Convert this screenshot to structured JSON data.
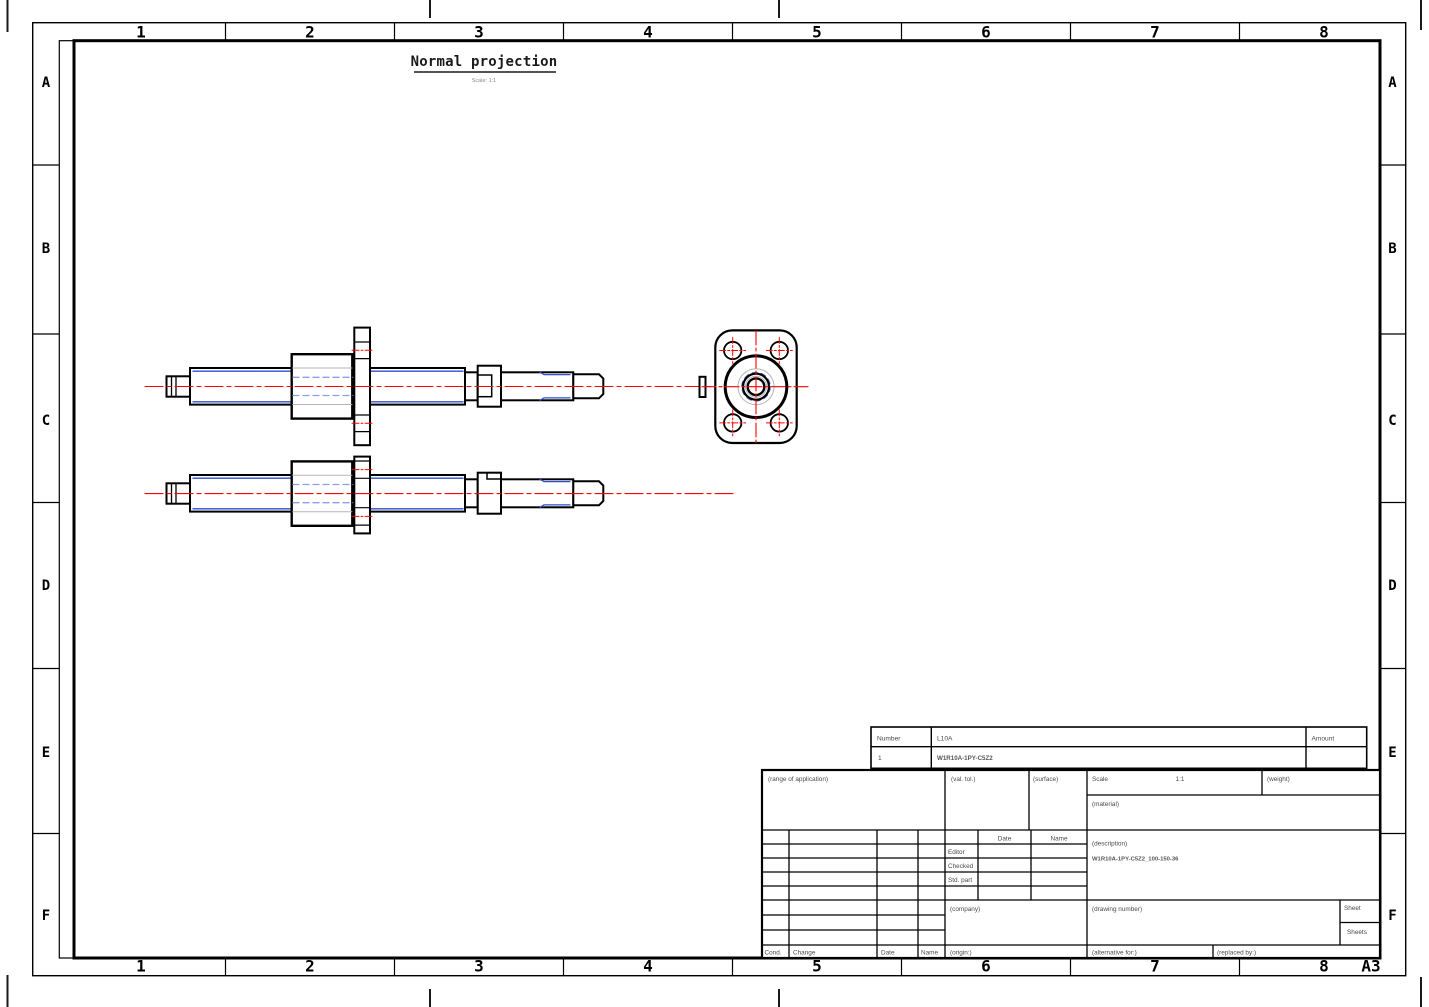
{
  "sheet": {
    "format": "A3",
    "paper_color": "#ffffff"
  },
  "colors": {
    "outline": "#000000",
    "centerline": "#ff0000",
    "hidden_blue": "#2e4fd0",
    "hidden_light_blue": "#8ba0e8",
    "ghost_gray": "#b5b5b5"
  },
  "view_title": {
    "text": "Normal projection",
    "caption": "Scale: 1:1"
  },
  "zones": {
    "cols": [
      "1",
      "2",
      "3",
      "4",
      "5",
      "6",
      "7",
      "8"
    ],
    "rows": [
      "A",
      "B",
      "C",
      "D",
      "E",
      "F"
    ],
    "format": "A3"
  },
  "parts_list": {
    "headers": {
      "number": "Number",
      "name": "L10A",
      "amount": "Amount"
    },
    "rows": [
      {
        "number": "1",
        "name": "W1R10A-1PY-C5Z2",
        "amount": ""
      }
    ]
  },
  "title_block": {
    "range_of_application": "(range of application)",
    "val_tol": "(val. tol.)",
    "surface": "(surface)",
    "scale_label": "Scale",
    "scale_value": "1:1",
    "weight": "(weight)",
    "material": "(material)",
    "description_label": "(description)",
    "description_value": "W1R10A-1PY-C5Z2_100-150-36",
    "date_header": "Date",
    "name_header": "Name",
    "editor": "Editor",
    "checked": "Checked",
    "std_part": "Std. part",
    "company": "(company)",
    "drawing_number": "(drawing number)",
    "sheet": "Sheet",
    "sheets": "Sheets",
    "cond": "Cond.",
    "change": "Change",
    "date_col": "Date",
    "name_col": "Name",
    "origin": "(origin:)",
    "alternative_for": "(alternative for:)",
    "replaced_by": "(replaced by:)"
  }
}
